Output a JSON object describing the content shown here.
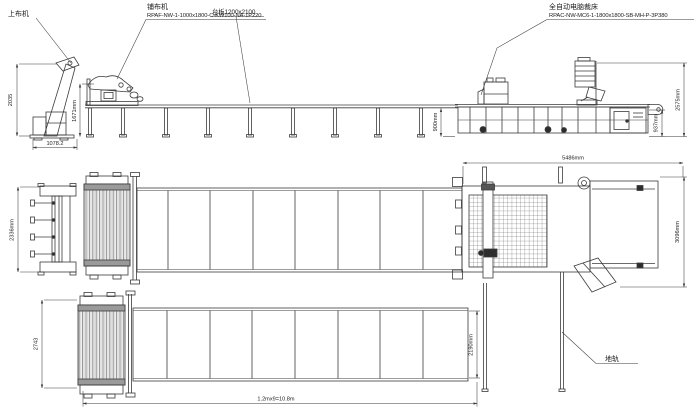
{
  "labels": {
    "loader": "上布机",
    "spreader_name": "铺布机",
    "spreader_model": "RPAF-NW-1-1000x1800-C-KW100-NA-1P220",
    "platen": "台板1200x2100",
    "cutter_name": "全自动电脑裁床",
    "cutter_model": "RPAC-NW-MC6-1-1800x1800-SB-MH-P-3P380",
    "ground_rail": "地轨"
  },
  "dimensions": {
    "loader_height": "2035",
    "loader_base_width": "1078.2",
    "spreader_height": "1671mm",
    "table_height": "900mm",
    "cutter_rear_height": "937mm",
    "cutter_overall_height": "2575mm",
    "cutter_length": "5486mm",
    "loader_plan_width": "2336mm",
    "cutter_plan_width": "3096mm",
    "spreader_plan_width": "2743",
    "table_plan_width": "2190mm",
    "table_total_length": "1.2mx9=10.8m"
  },
  "colors": {
    "line": "#3b3b3b",
    "background": "#ffffff"
  }
}
